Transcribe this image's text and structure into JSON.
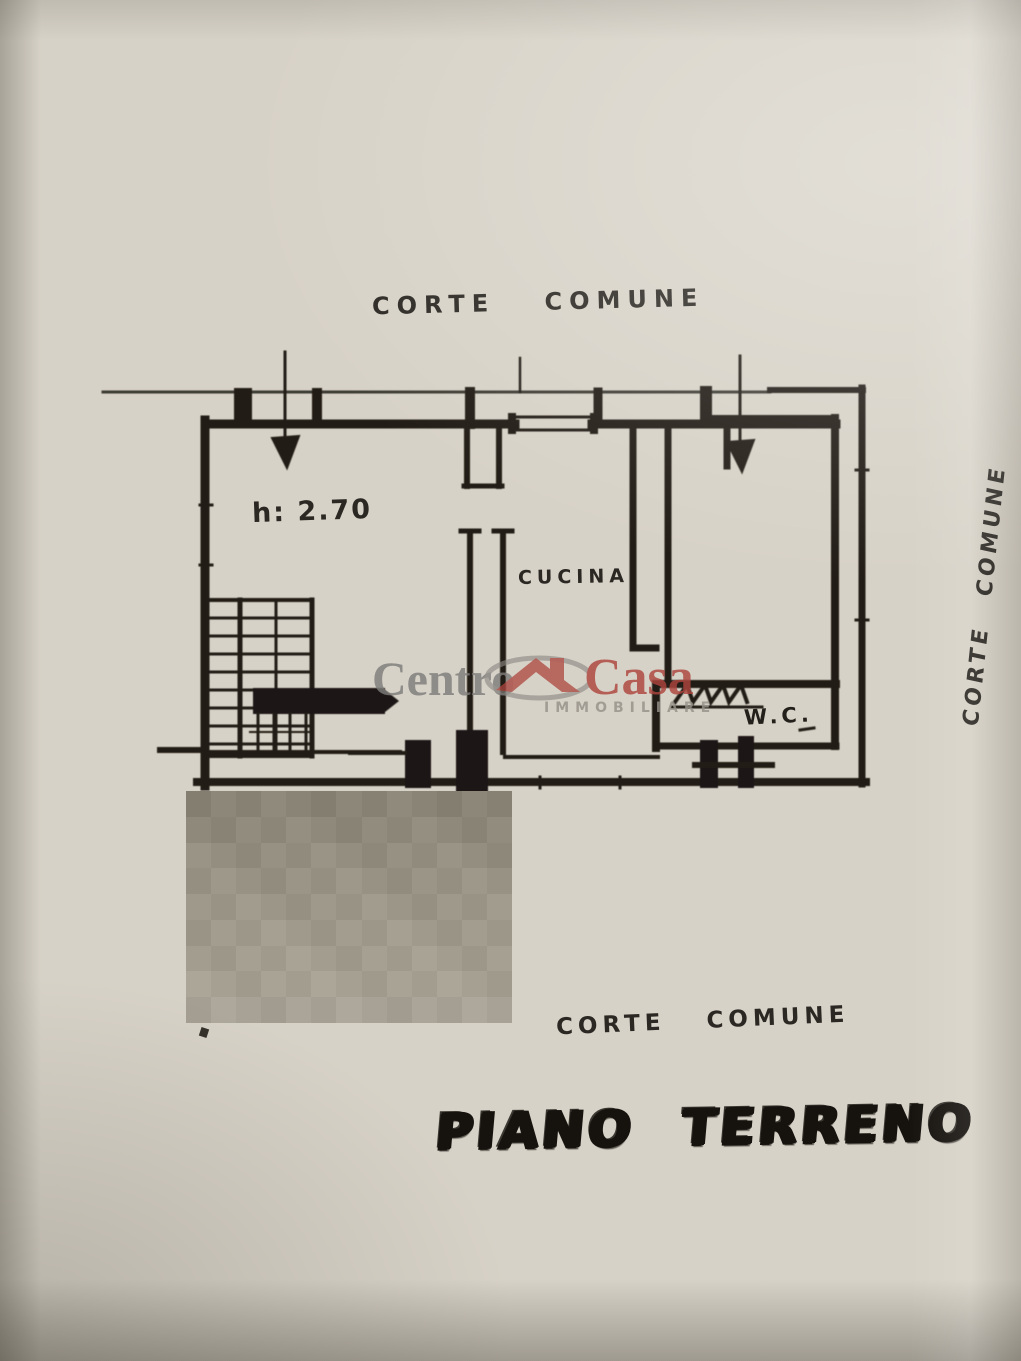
{
  "plan": {
    "labels": {
      "top_court": "CORTE COMUNE",
      "right_court": "CORTE COMUNE",
      "bottom_court": "CORTE COMUNE",
      "floor_title": "PIANO TERRENO",
      "kitchen": "CUCINA",
      "wc": "W.C.",
      "ceiling_height": "h: 2.70"
    },
    "ink_color": "#211e19",
    "paper_color": "#d7d2c7"
  },
  "watermark": {
    "part1": "Centro",
    "part2": "Casa",
    "subtitle": "IMMOBILIARE",
    "gray_color": "#7e7d7b",
    "red_color": "#ad453e"
  },
  "redaction": {
    "row_colors": [
      "#8a8477",
      "#8f897c",
      "#948e81",
      "#989285",
      "#9c9689",
      "#a09a8d",
      "#a39d90",
      "#a6a093",
      "#a8a296"
    ]
  }
}
